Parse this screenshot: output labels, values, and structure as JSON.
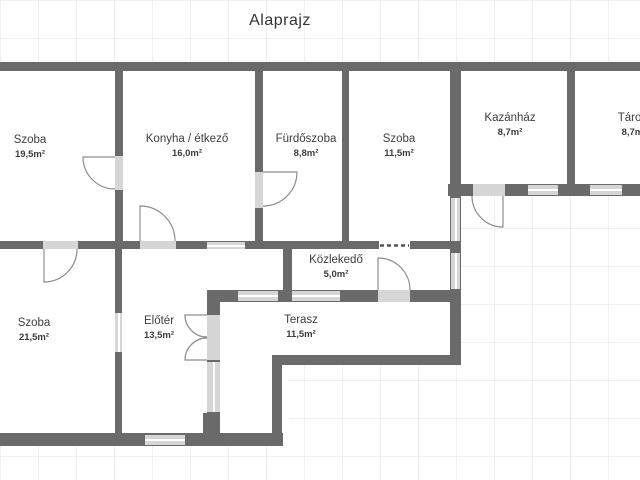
{
  "title": "Alaprajz",
  "colors": {
    "wall": "#6a6a6a",
    "opening_fill": "#d6d6d6",
    "arc_stroke": "#8d8d8d",
    "dash_stroke": "#555555",
    "text": "#3d3d3d",
    "grid": "#f0f0f0"
  },
  "rooms": [
    {
      "name": "Szoba",
      "area": "19,5m²",
      "label": [
        30,
        147
      ],
      "rect": [
        0,
        70,
        119,
        175
      ]
    },
    {
      "name": "Konyha / étkező",
      "area": "16,0m²",
      "label": [
        187,
        146
      ],
      "rect": [
        115,
        70,
        144,
        175
      ]
    },
    {
      "name": "Fürdőszoba",
      "area": "8,8m²",
      "label": [
        306,
        146
      ],
      "rect": [
        259,
        70,
        87,
        175
      ]
    },
    {
      "name": "Szoba",
      "area": "11,5m²",
      "label": [
        399,
        146
      ],
      "rect": [
        345,
        70,
        109,
        175
      ]
    },
    {
      "name": "Kazánház",
      "area": "8,7m²",
      "label": [
        510,
        125
      ],
      "rect": [
        455,
        70,
        117,
        118
      ]
    },
    {
      "name": "Tároló",
      "area": "8,7m²",
      "label": [
        634,
        125
      ],
      "rect": [
        572,
        70,
        68,
        118
      ]
    },
    {
      "name": "Szoba",
      "area": "21,5m²",
      "label": [
        34,
        330
      ],
      "rect": [
        0,
        245,
        119,
        192
      ]
    },
    {
      "name": "Előtér",
      "area": "13,5m²",
      "label": [
        159,
        328
      ],
      "rect": [
        119,
        245,
        170,
        192
      ]
    },
    {
      "name": "Közlekedő",
      "area": "5,0m²",
      "label": [
        336,
        267
      ],
      "rect": [
        289,
        245,
        163,
        57
      ]
    },
    {
      "name": "Terasz",
      "area": "11,5m²",
      "label": [
        301,
        327
      ],
      "rect": [
        213,
        296,
        239,
        62
      ]
    }
  ],
  "plan": {
    "extra_fills": [
      [
        213,
        358,
        62,
        77
      ]
    ],
    "walls": [
      [
        0,
        62,
        640,
        9
      ],
      [
        0,
        241,
        460,
        8
      ],
      [
        448,
        184,
        192,
        12
      ],
      [
        207,
        290,
        253,
        12
      ],
      [
        272,
        355,
        185,
        10
      ],
      [
        0,
        433,
        283,
        13
      ],
      [
        203,
        413,
        17,
        20
      ],
      [
        115,
        70,
        8,
        172
      ],
      [
        255,
        70,
        8,
        172
      ],
      [
        342,
        70,
        7,
        172
      ],
      [
        450,
        70,
        11,
        295
      ],
      [
        567,
        70,
        8,
        126
      ],
      [
        115,
        249,
        7,
        184
      ],
      [
        283,
        249,
        9,
        53
      ],
      [
        207,
        302,
        13,
        13
      ],
      [
        207,
        360,
        13,
        73
      ],
      [
        272,
        360,
        10,
        75
      ],
      [
        376,
        241,
        3,
        8
      ],
      [
        410,
        241,
        3,
        8
      ]
    ],
    "windows": [
      {
        "rect": [
          207,
          242,
          38,
          7
        ],
        "orient": "h"
      },
      {
        "rect": [
          145,
          435,
          40,
          10
        ],
        "orient": "h"
      },
      {
        "rect": [
          115,
          313,
          7,
          39
        ],
        "orient": "v"
      },
      {
        "rect": [
          207,
          362,
          13,
          50
        ],
        "orient": "v"
      },
      {
        "rect": [
          451,
          198,
          9,
          43
        ],
        "orient": "v"
      },
      {
        "rect": [
          451,
          253,
          9,
          36
        ],
        "orient": "v"
      },
      {
        "rect": [
          238,
          291,
          40,
          10
        ],
        "orient": "h"
      },
      {
        "rect": [
          292,
          291,
          48,
          10
        ],
        "orient": "h"
      },
      {
        "rect": [
          528,
          185,
          30,
          10
        ],
        "orient": "h"
      },
      {
        "rect": [
          590,
          185,
          32,
          10
        ],
        "orient": "h"
      }
    ],
    "door_slabs": [
      [
        43,
        241,
        35,
        8
      ],
      [
        140,
        241,
        36,
        8
      ],
      [
        115,
        156,
        8,
        34
      ],
      [
        255,
        172,
        8,
        36
      ],
      [
        378,
        290,
        32,
        12
      ],
      [
        473,
        184,
        32,
        12
      ],
      [
        207,
        315,
        13,
        45
      ]
    ],
    "door_arcs": [
      {
        "d": "M44,249 L44,282 A33,33 0 0 0 77,249"
      },
      {
        "d": "M140,241 L140,206 A35,35 0 0 1 175,241"
      },
      {
        "d": "M115,157 L83,157 A32,32 0 0 0 115,189"
      },
      {
        "d": "M263,172 L297,172 A34,34 0 0 1 263,206"
      },
      {
        "d": "M378,290 L378,258 A32,32 0 0 1 410,290"
      },
      {
        "d": "M503,196 L503,227 A31,31 0 0 1 472,196"
      },
      {
        "d": "M207,315 L185,315 A22,22 0 0 0 207,337"
      },
      {
        "d": "M207,360 L185,360 A22,22 0 0 1 207,338"
      }
    ],
    "dashed_openings": [
      {
        "gap": [
          379,
          241,
          31,
          8
        ],
        "d": "M380,245.5 L409,245.5"
      }
    ]
  }
}
